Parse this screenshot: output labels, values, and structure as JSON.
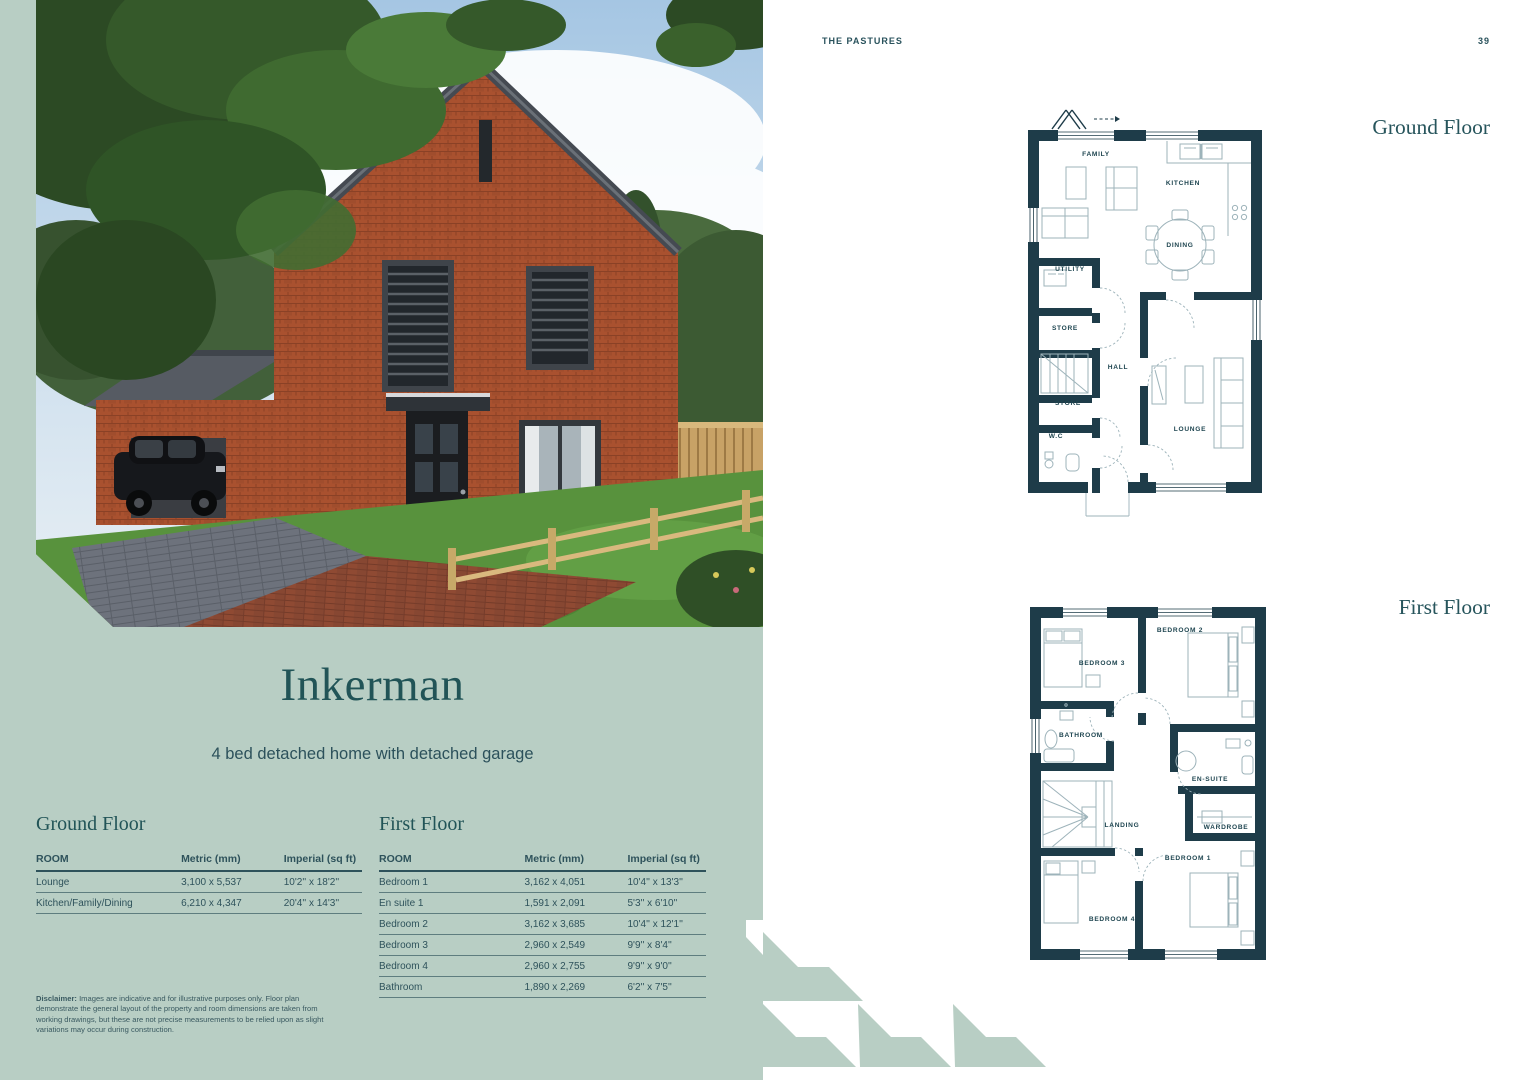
{
  "page": {
    "header": "THE PASTURES",
    "page_number": "39"
  },
  "property": {
    "name": "Inkerman",
    "subtitle": "4 bed detached home with detached garage"
  },
  "tables": {
    "columns": [
      "ROOM",
      "Metric (mm)",
      "Imperial (sq ft)"
    ],
    "ground_floor": {
      "title": "Ground Floor",
      "rows": [
        [
          "Lounge",
          "3,100 x 5,537",
          "10'2'' x 18'2''"
        ],
        [
          "Kitchen/Family/Dining",
          "6,210 x 4,347",
          "20'4'' x 14'3''"
        ]
      ]
    },
    "first_floor": {
      "title": "First Floor",
      "rows": [
        [
          "Bedroom 1",
          "3,162 x 4,051",
          "10'4'' x 13'3''"
        ],
        [
          "En suite 1",
          "1,591 x 2,091",
          "5'3'' x 6'10''"
        ],
        [
          "Bedroom 2",
          "3,162 x 3,685",
          "10'4'' x 12'1''"
        ],
        [
          "Bedroom 3",
          "2,960 x 2,549",
          "9'9'' x 8'4''"
        ],
        [
          "Bedroom 4",
          "2,960 x 2,755",
          "9'9'' x 9'0''"
        ],
        [
          "Bathroom",
          "1,890 x 2,269",
          "6'2'' x 7'5''"
        ]
      ]
    }
  },
  "disclaimer": {
    "label": "Disclaimer:",
    "text": " Images are indicative and for illustrative purposes only. Floor plan demonstrate the general layout of the property and room dimensions are taken from working drawings, but these are not precise measurements to be relied upon as slight variations may occur during construction."
  },
  "plans": {
    "ground": {
      "title": "Ground Floor",
      "rooms": [
        "FAMILY",
        "KITCHEN",
        "DINING",
        "UTILITY",
        "STORE",
        "HALL",
        "STORE",
        "W.C",
        "LOUNGE"
      ]
    },
    "first": {
      "title": "First Floor",
      "rooms": [
        "BEDROOM 3",
        "BEDROOM 2",
        "BATHROOM",
        "EN-SUITE",
        "WARDROBE",
        "LANDING",
        "BEDROOM 4",
        "BEDROOM 1"
      ]
    }
  },
  "colors": {
    "sage_background": "#b8cec4",
    "teal_heading": "#215457",
    "plan_wall": "#1e3c49",
    "plan_furniture_line": "#9db3ba",
    "table_text": "#2e525b"
  }
}
